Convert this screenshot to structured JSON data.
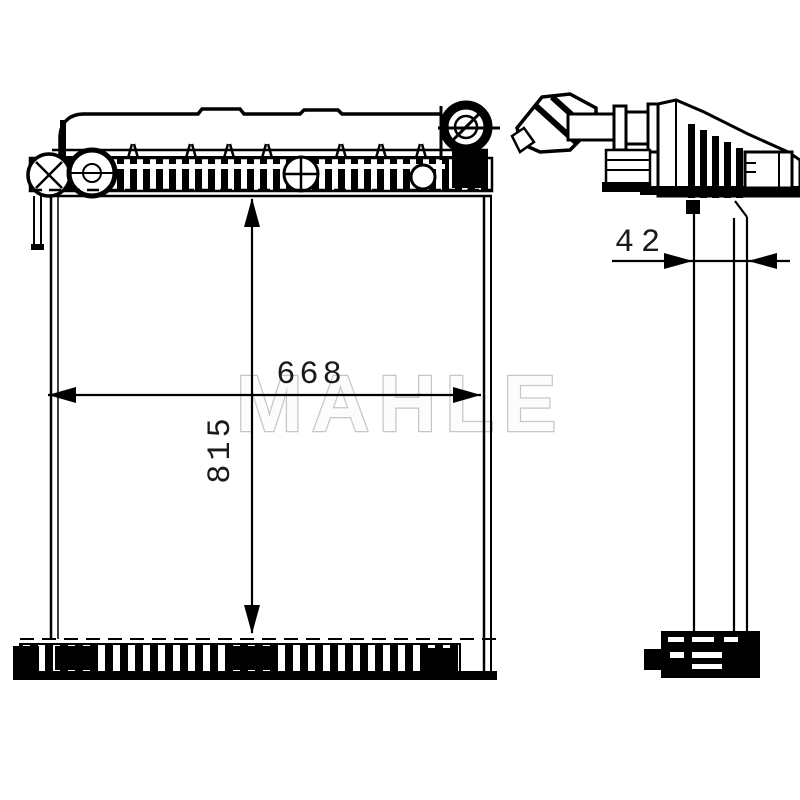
{
  "drawing": {
    "type": "radiator technical drawing, front and side views",
    "watermark": "MAHLE",
    "dimensions": {
      "width_mm": "668",
      "height_mm": "815",
      "depth_mm": "42"
    },
    "colors": {
      "line": "#000000",
      "background": "#ffffff",
      "watermark_outline": "#c6c6c6"
    }
  }
}
